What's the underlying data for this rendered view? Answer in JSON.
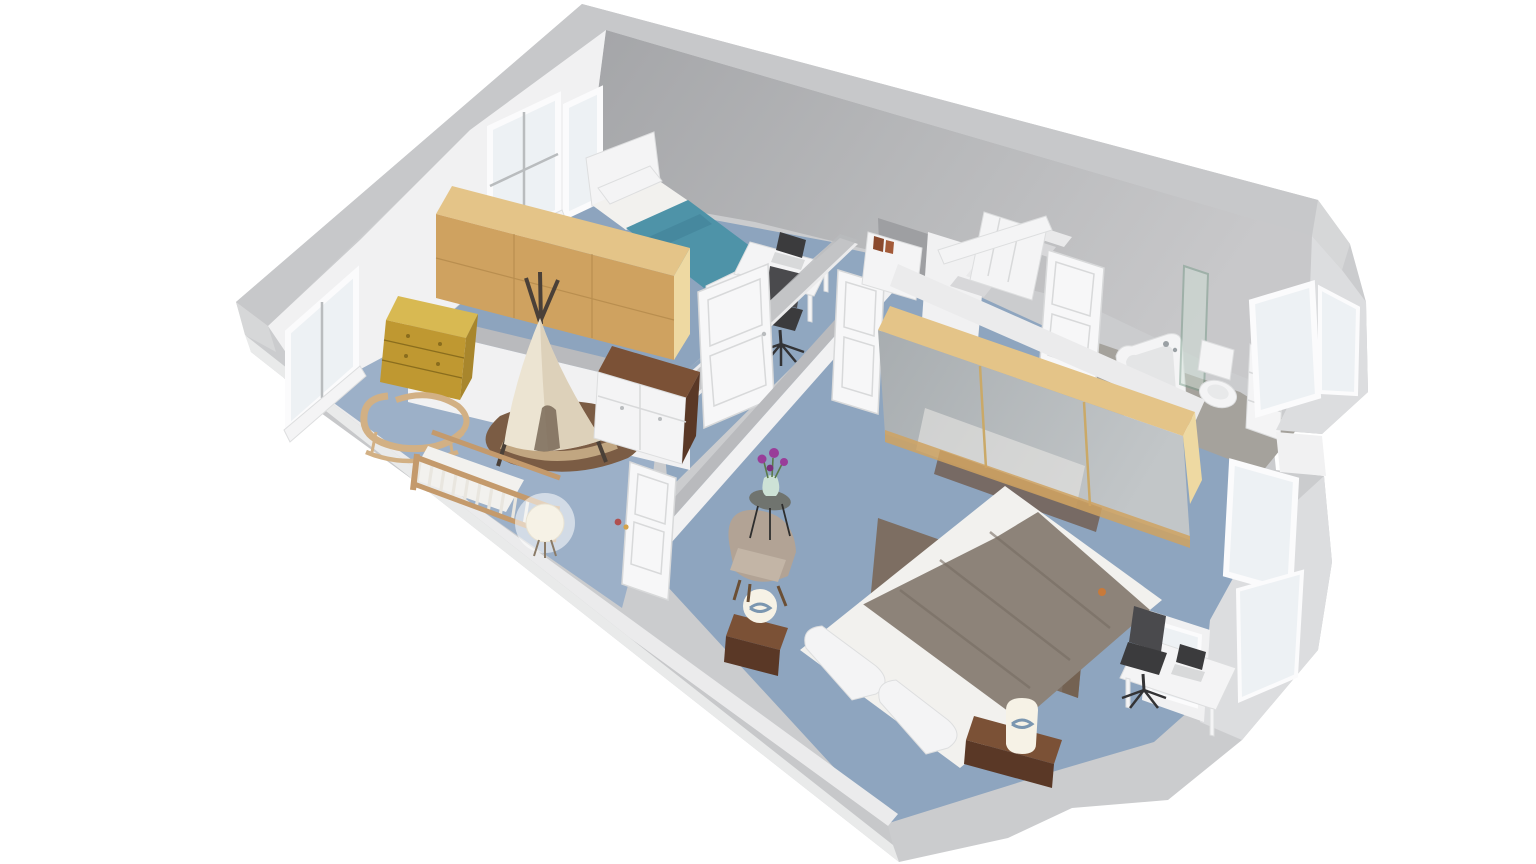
{
  "scene": {
    "kind": "3d-isometric-floor-plan-render",
    "background": "#ffffff",
    "floor_shown": "upper floor with two bedrooms, nursery area, hallway, staircase and bathroom",
    "no_visible_text": true
  },
  "palette": {
    "bg": "#ffffff",
    "ext_base": "#cbccce",
    "ext_band": "#c7c8ca",
    "ext_face": "#e9eaea",
    "ext_cap": "#d6d7d8",
    "ext_light": "#dcdddf",
    "int_wall_a": "#a4a5a8",
    "int_wall_b": "#c8c8ca",
    "wall_white": "#f1f1f2",
    "wall_white2": "#ebebec",
    "wall_shadow": "#dfdfe1",
    "cap_gray": "#b9babd",
    "floor_kid": "#8da4be",
    "floor_hall": "#90a7c0",
    "floor_nursery": "#9cb0c8",
    "floor_master": "#8ea5bf",
    "floor_bath": "#a5a29c",
    "glass": "#edf1f4",
    "frame_white": "#fbfbfc",
    "frame_gray": "#b9bcbe",
    "door_white": "#f7f7f8",
    "door_line": "#d8d9da",
    "oak_top": "#e4c488",
    "oak_front": "#cfa260",
    "oak_side": "#eed9a2",
    "oak_dark": "#a87f42",
    "gold_top": "#d8b952",
    "gold_front": "#bf9831",
    "gold_side": "#a8862c",
    "gold_line": "#8a6d1d",
    "teal": "#4e93a8",
    "teal_dark": "#3f8095",
    "white_furn": "#f4f4f5",
    "white_furn_line": "#dddedf",
    "sheet": "#f2f1ee",
    "blanket": "#8d8379",
    "blanket_fold": "#776d63",
    "rug_master": "#7d6e62",
    "walnut": "#7b5136",
    "walnut_dark": "#5a3826",
    "crib_wood": "#c49a6c",
    "crib_slat": "#e9e6df",
    "rattan": "#d2b084",
    "teepee": "#ece4d2",
    "teepee_shade": "#d9ccb4",
    "teepee_door": "#7a6a58",
    "round_rug": "#7b5c44",
    "round_rug_path": "#c9ae88",
    "armchair": "#c3b5a6",
    "armchair_dark": "#b2a395",
    "lamp": "#f6f2e6",
    "lamp_blue": "#5b7ea3",
    "chair_black": "#3b3b3d",
    "chair_black2": "#4a4a4d",
    "mirror_a": "#a8adb0",
    "mirror_b": "#c2c6c8",
    "mirror_seam": "#caa968",
    "shower_glass": "#cfe0d6",
    "shower_edge": "#6f9682",
    "flower": "#993d99",
    "vase": "#cde2d6",
    "stem": "#5a7a4a",
    "metal": "#9aa0a4",
    "book": "#8a4a2e",
    "wood_rail": "#7b4a2e",
    "toy_red": "#b05050",
    "toy_yellow": "#d4a24a",
    "accent_orange": "#c87a3a",
    "shadow": "#000000"
  },
  "rooms": [
    {
      "name": "kids-bedroom",
      "furniture": [
        "single-bed-teal",
        "double-window",
        "long-oak-wardrobe",
        "white-desk",
        "laptop",
        "black-office-chair",
        "paneled-door"
      ]
    },
    {
      "name": "nursery-area",
      "furniture": [
        "gold-dresser",
        "rattan-rocking-chair",
        "wooden-crib",
        "sphere-floor-lamp",
        "teepee-tent",
        "round-brown-rug",
        "white-changing-dresser",
        "window",
        "open-door",
        "toy"
      ]
    },
    {
      "name": "hallway",
      "furniture": [
        "staircase",
        "handrail",
        "white-bookcase"
      ]
    },
    {
      "name": "bathroom",
      "furniture": [
        "bathtub",
        "glass-shower-screen",
        "toilet",
        "white-cabinet",
        "bay-window",
        "open-door"
      ]
    },
    {
      "name": "master-bedroom",
      "furniture": [
        "double-bed-gray-blanket",
        "area-rug",
        "two-nightstands",
        "two-lamps",
        "mirrored-oak-wardrobe",
        "armchair",
        "side-table",
        "flower-vase",
        "desk-nook",
        "laptop",
        "office-chair",
        "bay-windows"
      ]
    }
  ]
}
